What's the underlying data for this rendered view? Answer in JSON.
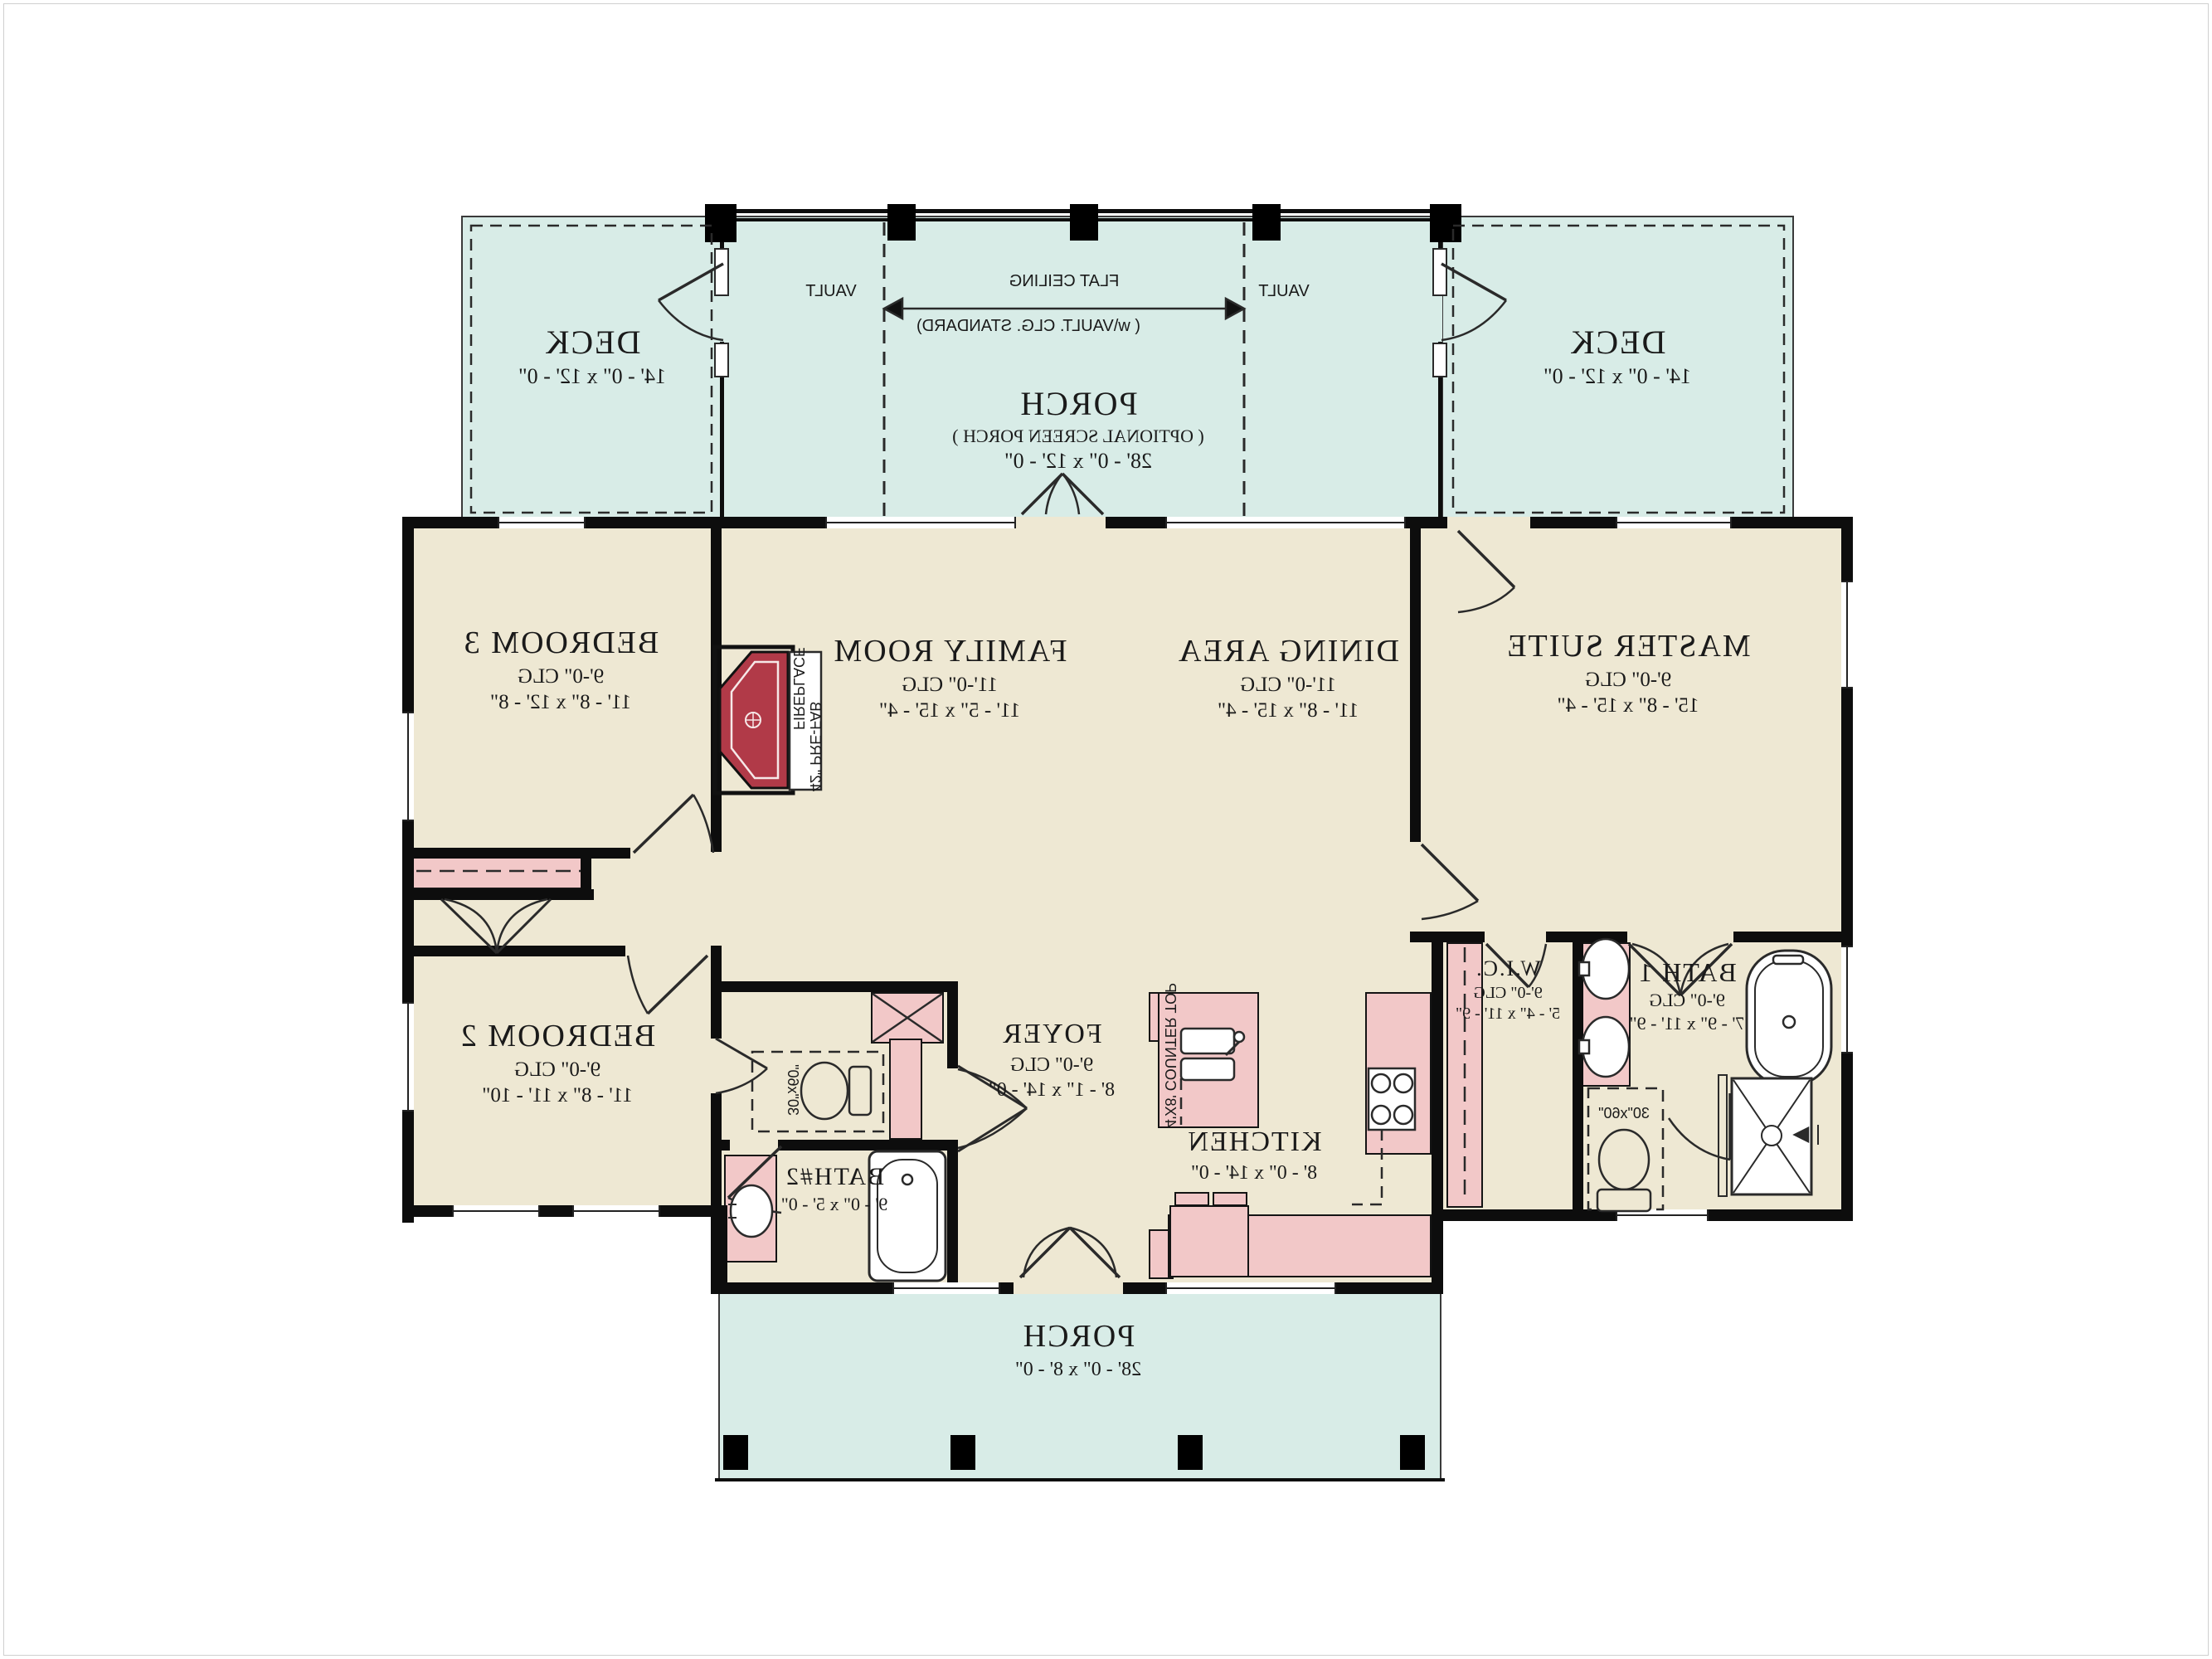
{
  "drawing": {
    "type": "house floor plan",
    "orientation": "mirror-imaged blueprint"
  },
  "palette": {
    "outdoor_teal": "#d8ece7",
    "interior_beige": "#eee8d3",
    "fixture_pink": "#f2c8c8",
    "fireplace_red": "#b13a48",
    "wall_black": "#0d0d0d",
    "background": "#ffffff"
  },
  "outdoor": {
    "deck_left": {
      "name": "DECK",
      "dims": "14' - 0\" x 12' - 0\""
    },
    "deck_right": {
      "name": "DECK",
      "dims": "14' - 0\" x 12' - 0\""
    },
    "screen_porch": {
      "name": "PORCH",
      "note": "( OPTIONAL SCREEN PORCH )",
      "dims": "28' - 0\" x 12' - 0\""
    },
    "front_porch": {
      "name": "PORCH",
      "dims": "28' - 0\" x 8' - 0\""
    }
  },
  "ceiling": {
    "flat": "FLAT CEILING",
    "standard": "( w\\VAULT. CLG. STANDARD)",
    "vault_left": "VAULT",
    "vault_right": "VAULT"
  },
  "rooms": {
    "bedroom3": {
      "name": "BEDROOM 3",
      "clg": "9'-0\" CLG",
      "dims": "11' - 8\" x 12' - 8\""
    },
    "family": {
      "name": "FAMILY ROOM",
      "clg": "11'-0\" CLG",
      "dims": "11' - 5\" x 15' - 4\""
    },
    "dining": {
      "name": "DINING AREA",
      "clg": "11'-0\" CLG",
      "dims": "11' - 8\" x 15' - 4\""
    },
    "master": {
      "name": "MASTER SUITE",
      "clg": "9'-0\" CLG",
      "dims": "15' - 8\" x 15' - 4\""
    },
    "bedroom2": {
      "name": "BEDROOM 2",
      "clg": "9'-0\" CLG",
      "dims": "11' - 8\" x 11' - 10\""
    },
    "foyer": {
      "name": "FOYER",
      "clg": "9'-0\" CLG",
      "dims": "8' - 1\" x 14' - 0\""
    },
    "kitchen": {
      "name": "KITCHEN",
      "dims": "8' - 0\" x 14' - 0\""
    },
    "wic": {
      "name": "W.I.C.",
      "clg": "9'-0\" CLG",
      "dims": "5' - 4\" x 11' - 9\""
    },
    "bath1": {
      "name": "BATH 1",
      "clg": "9'-0\" CLG",
      "dims": "7' - 9\" x 11' - 9\""
    },
    "bath2": {
      "name": "BATH#2",
      "dims": "9' - 0\" x 5' - 0\""
    }
  },
  "fixtures": {
    "fireplace_line1": "FIREPLACE",
    "fireplace_line2": "42\" PRE-FAB",
    "island_counter": "4'X8' COUNTER TOP",
    "shower_bath2": "30\"x60\"",
    "shower_bath1": "30\"x60\""
  }
}
